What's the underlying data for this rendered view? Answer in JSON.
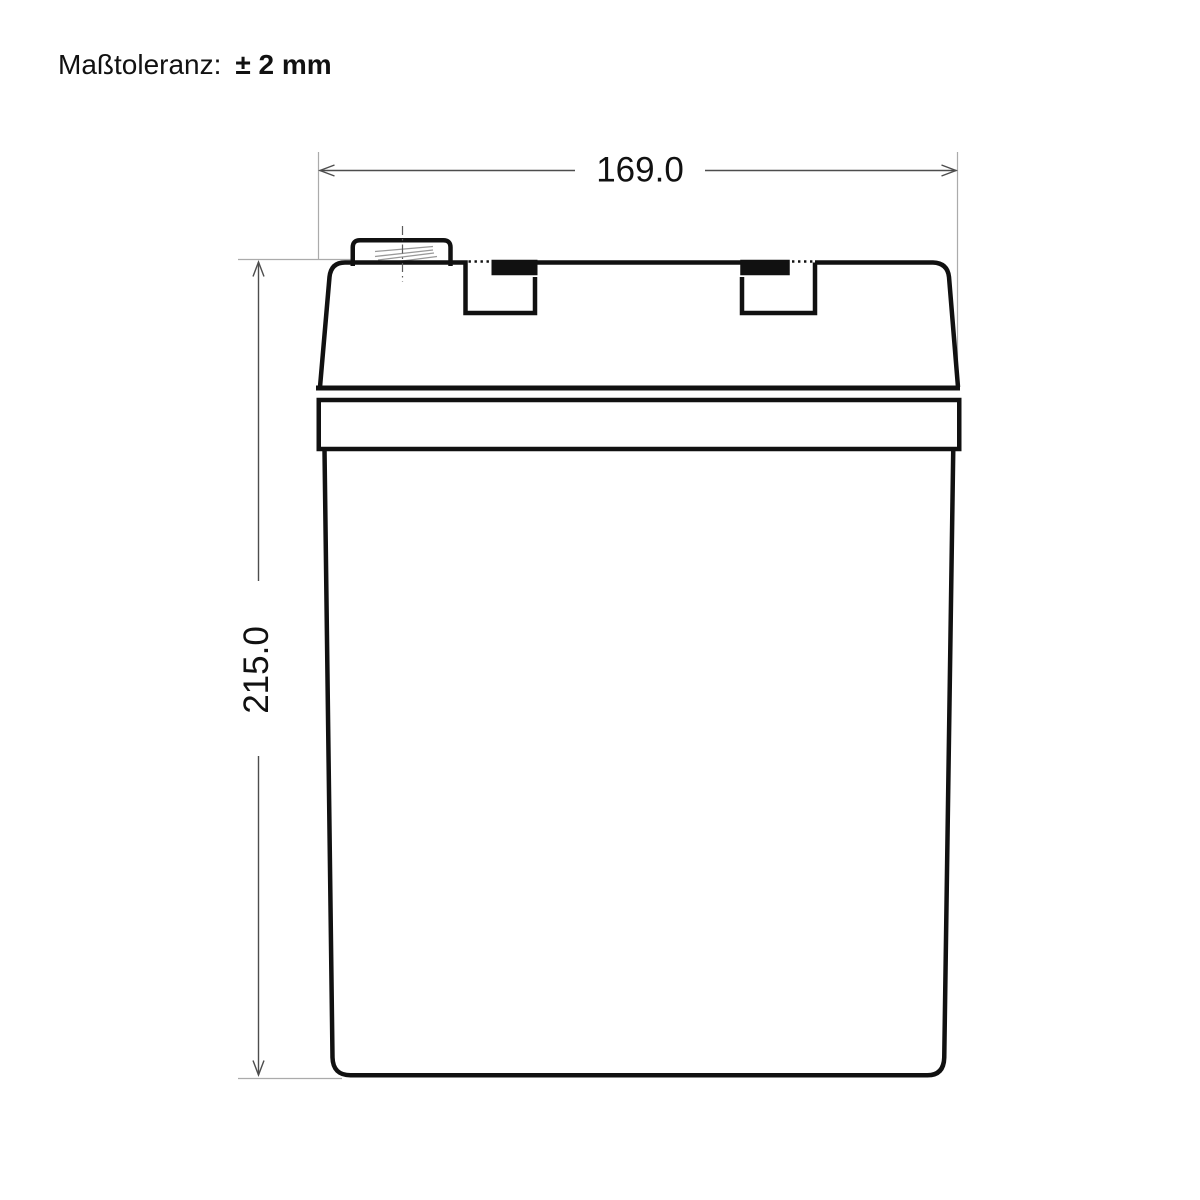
{
  "page": {
    "background": "#ffffff"
  },
  "tolerance_note": {
    "label": "Maßtoleranz:",
    "value": "± 2 mm"
  },
  "dimensions": {
    "width_label": "169.0",
    "height_label": "215.0"
  },
  "colors": {
    "outline": "#111111",
    "fill": "#ffffff",
    "dimension_line": "#4d4d4d",
    "extension_line": "#ababab",
    "centerline": "#5c5c5c",
    "hatch": "#999999",
    "text": "#111111"
  }
}
